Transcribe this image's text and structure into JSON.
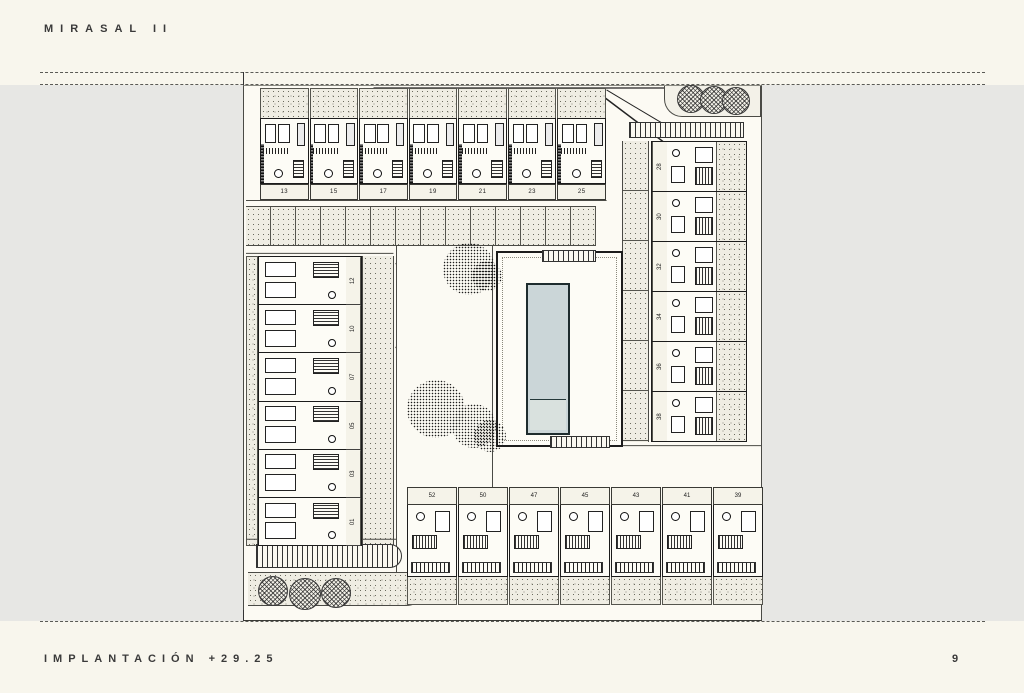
{
  "header": {
    "title": "MIRASAL II"
  },
  "footer": {
    "label": "IMPLANTACIÓN +29.25",
    "page_number": "9"
  },
  "plan": {
    "description": "site implantation plan, housing units around central courtyard with pool",
    "rows": {
      "top": [
        "13",
        "15",
        "17",
        "19",
        "21",
        "23",
        "25"
      ],
      "right": [
        "28",
        "30",
        "32",
        "34",
        "36",
        "38"
      ],
      "left": [
        "12",
        "10",
        "07",
        "05",
        "03",
        "01"
      ],
      "bottom": [
        "52",
        "50",
        "47",
        "45",
        "43",
        "41",
        "39"
      ]
    },
    "colors": {
      "paper": "#f8f6ed",
      "surround_gray": "#e7e7e4",
      "line": "#2f2f2f",
      "garden_stipple": "#efede3",
      "pool_water": "#cbd6d8"
    }
  }
}
